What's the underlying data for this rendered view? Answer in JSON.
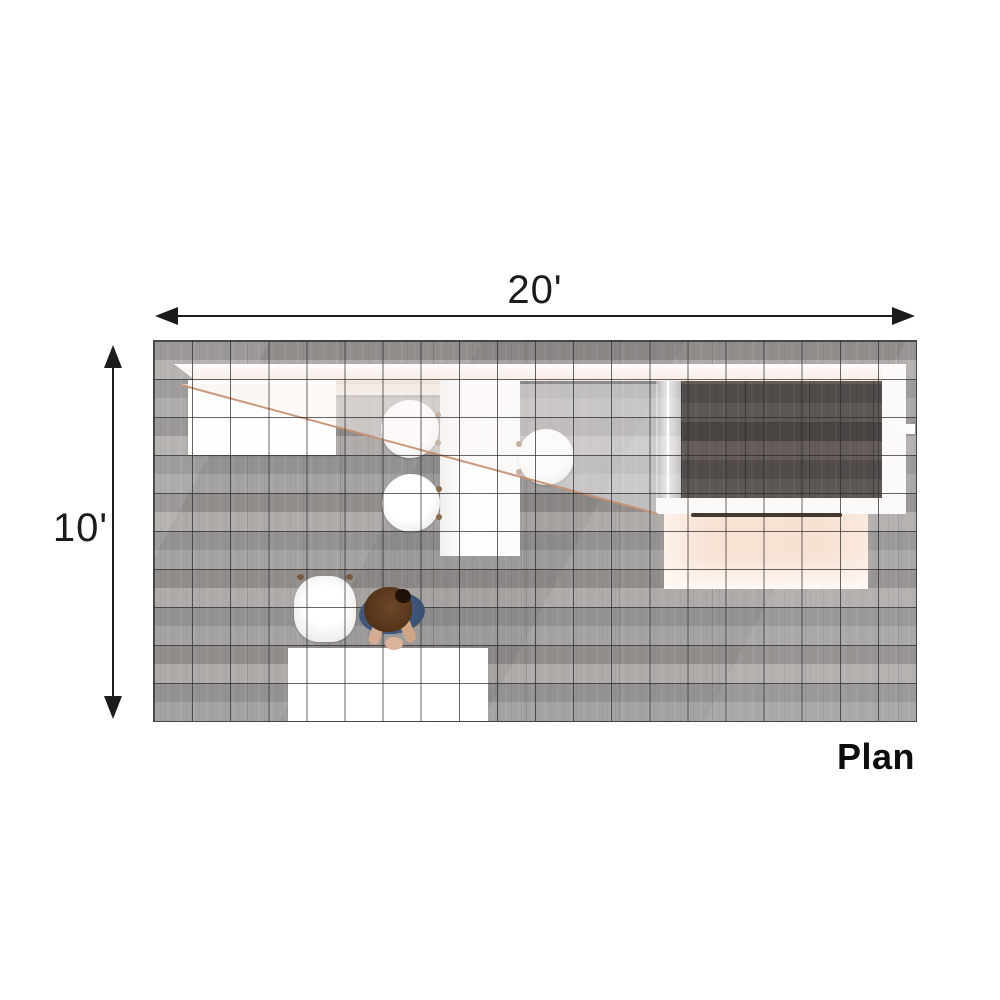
{
  "dimensions": {
    "width_label": "20'",
    "height_label": "10'",
    "width_feet": 20,
    "depth_feet": 10
  },
  "view": {
    "label": "Plan"
  },
  "grid": {
    "columns": 20,
    "rows": 10,
    "cell_size_feet": 1
  },
  "colors": {
    "background": "#ffffff",
    "floor_wood_gray": "#9c9a98",
    "room_dark_wood": "#565150",
    "grid_line": "#2b2b2b",
    "canopy_edge_tan": "#c69276",
    "peach_surface": "#f8e2d4",
    "furniture_white": "#ffffff",
    "bench_dark": "#45382e",
    "person_shirt_blue": "#3f5878",
    "person_hair_brown": "#54351b",
    "dimension_text": "#1c1c1c"
  },
  "elements": [
    "back-wall-band",
    "wall-counter",
    "reception-desk",
    "central-high-table",
    "round-chair-left-upper",
    "round-chair-left-lower",
    "round-chair-right",
    "overhead-canopy",
    "enclosed-room-glass-wall",
    "enclosed-room-dark-floor",
    "enclosed-room-right-wall",
    "enclosed-room-bottom-wall",
    "doorway-notch",
    "bench",
    "peach-mat",
    "coffee-table",
    "tub-armchair",
    "standing-person"
  ]
}
